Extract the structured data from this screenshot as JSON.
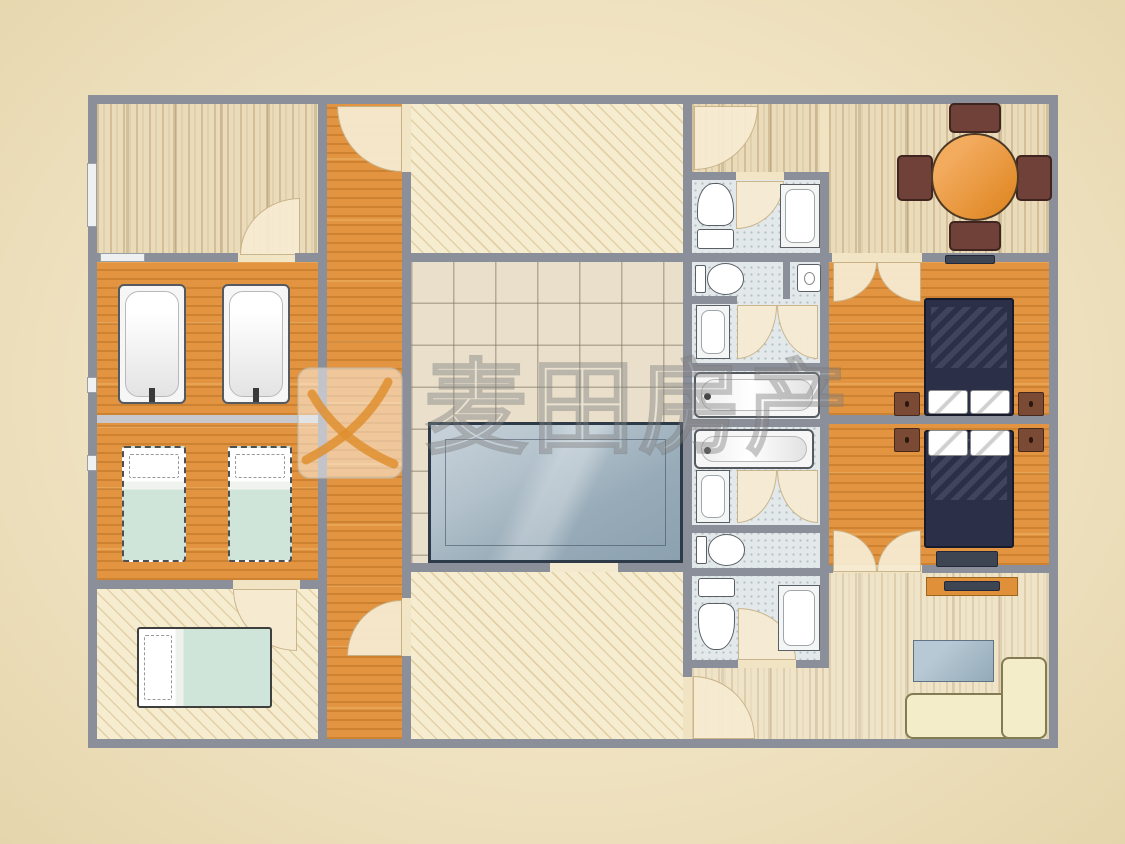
{
  "watermark": {
    "text": "麦田房产",
    "logo": "maitian-logo"
  },
  "palette": {
    "background": "#f0e3c2",
    "wall": "#8b8f99",
    "wood_floor": "#eadcba",
    "orange_floor": "#e29440",
    "hatch_floor": "#f6ecd0",
    "tile_floor": "#e9dfcb",
    "bath_floor": "#e3e9ea",
    "pool_water": "#9fb2bf",
    "bed_dark": "#2b3048",
    "bed_mint": "#cfe5da",
    "sofa_cream": "#f3edca",
    "table_orange": "#e18a28",
    "chair_brown": "#6f4138",
    "watermark_orange": "#df8f2f"
  },
  "floorplan": {
    "elements": [
      {
        "n": "top-left-room-floor",
        "c": "f-wood",
        "x": 97,
        "y": 104,
        "w": 221,
        "h": 149
      },
      {
        "n": "tub-room-floor",
        "c": "f-orange",
        "x": 97,
        "y": 262,
        "w": 221,
        "h": 153
      },
      {
        "n": "twin-bedroom-floor",
        "c": "f-orange",
        "x": 97,
        "y": 423,
        "w": 221,
        "h": 157
      },
      {
        "n": "bottom-left-bedroom-floor",
        "c": "f-hatch",
        "x": 97,
        "y": 589,
        "w": 221,
        "h": 150
      },
      {
        "n": "corridor-floor",
        "c": "f-orange",
        "x": 327,
        "y": 104,
        "w": 75,
        "h": 635
      },
      {
        "n": "top-center-room-floor",
        "c": "f-hatch",
        "x": 411,
        "y": 104,
        "w": 272,
        "h": 149
      },
      {
        "n": "pool-room-floor",
        "c": "f-grid",
        "x": 411,
        "y": 262,
        "w": 272,
        "h": 301
      },
      {
        "n": "bottom-center-room-floor",
        "c": "f-hatch",
        "x": 411,
        "y": 572,
        "w": 272,
        "h": 167
      },
      {
        "n": "top-band-floor",
        "c": "f-wood",
        "x": 692,
        "y": 104,
        "w": 128,
        "h": 68
      },
      {
        "n": "dining-room-floor",
        "c": "f-wood",
        "x": 829,
        "y": 104,
        "w": 220,
        "h": 149
      },
      {
        "n": "bathroom-column-floor",
        "c": "f-bath",
        "x": 692,
        "y": 180,
        "w": 128,
        "h": 480
      },
      {
        "n": "bedroom1-floor",
        "c": "f-orange",
        "x": 829,
        "y": 262,
        "w": 220,
        "h": 153
      },
      {
        "n": "bedroom2-floor",
        "c": "f-orange",
        "x": 829,
        "y": 424,
        "w": 220,
        "h": 141
      },
      {
        "n": "living-room-floor",
        "c": "f-woodlight",
        "x": 829,
        "y": 573,
        "w": 220,
        "h": 166
      },
      {
        "n": "living-room-ext-floor",
        "c": "f-woodlight",
        "x": 692,
        "y": 668,
        "w": 137,
        "h": 71
      },
      {
        "n": "door-arc-topleft-room",
        "c": "fan rTL",
        "x": 240,
        "y": 198,
        "w": 60,
        "h": 57
      },
      {
        "n": "door-arc-bottomleft-room",
        "c": "fan rBL",
        "x": 233,
        "y": 589,
        "w": 64,
        "h": 62
      },
      {
        "n": "door-arc-corridor-top",
        "c": "fan rBL",
        "x": 337,
        "y": 106,
        "w": 65,
        "h": 66
      },
      {
        "n": "door-arc-corridor-bottom",
        "c": "fan rTL",
        "x": 347,
        "y": 600,
        "w": 55,
        "h": 56
      },
      {
        "n": "door-arc-topband",
        "c": "fan rBR",
        "x": 694,
        "y": 106,
        "w": 64,
        "h": 64
      },
      {
        "n": "door-arc-bath1",
        "c": "fan rBR",
        "x": 736,
        "y": 181,
        "w": 48,
        "h": 48
      },
      {
        "n": "door-arc-bath3-left",
        "c": "fan rBR",
        "x": 737,
        "y": 305,
        "w": 40,
        "h": 54
      },
      {
        "n": "door-arc-bath3-right",
        "c": "fan rBL",
        "x": 777,
        "y": 305,
        "w": 41,
        "h": 54
      },
      {
        "n": "door-arc-bath5-left",
        "c": "fan rBR",
        "x": 737,
        "y": 470,
        "w": 40,
        "h": 53
      },
      {
        "n": "door-arc-bath5-right",
        "c": "fan rBL",
        "x": 777,
        "y": 470,
        "w": 41,
        "h": 53
      },
      {
        "n": "door-arc-bath7",
        "c": "fan rTR",
        "x": 738,
        "y": 608,
        "w": 58,
        "h": 52
      },
      {
        "n": "door-arc-bedroom1-left",
        "c": "fan rBR",
        "x": 833,
        "y": 262,
        "w": 44,
        "h": 40
      },
      {
        "n": "door-arc-bedroom1-right",
        "c": "fan rBL",
        "x": 877,
        "y": 262,
        "w": 44,
        "h": 40
      },
      {
        "n": "door-arc-bedroom2-left",
        "c": "fan rTR",
        "x": 833,
        "y": 530,
        "w": 44,
        "h": 42
      },
      {
        "n": "door-arc-bedroom2-right",
        "c": "fan rTL",
        "x": 877,
        "y": 530,
        "w": 44,
        "h": 42
      },
      {
        "n": "door-arc-living",
        "c": "fan rTR",
        "x": 693,
        "y": 676,
        "w": 62,
        "h": 63
      },
      {
        "n": "outer-wall-top",
        "c": "wall",
        "x": 88,
        "y": 95,
        "w": 970,
        "h": 9
      },
      {
        "n": "outer-wall-bottom",
        "c": "wall",
        "x": 88,
        "y": 739,
        "w": 970,
        "h": 9
      },
      {
        "n": "outer-wall-left",
        "c": "wall",
        "x": 88,
        "y": 95,
        "w": 9,
        "h": 653
      },
      {
        "n": "outer-wall-right",
        "c": "wall",
        "x": 1049,
        "y": 95,
        "w": 9,
        "h": 653
      },
      {
        "n": "wall-left-rooms",
        "c": "wall",
        "x": 318,
        "y": 104,
        "w": 9,
        "h": 635
      },
      {
        "n": "wall-corridor-right-upper",
        "c": "wall",
        "x": 402,
        "y": 172,
        "w": 9,
        "h": 426
      },
      {
        "n": "wall-corridor-right-lower",
        "c": "wall",
        "x": 402,
        "y": 656,
        "w": 9,
        "h": 83
      },
      {
        "n": "wall-center-right",
        "c": "wall",
        "x": 683,
        "y": 104,
        "w": 9,
        "h": 573
      },
      {
        "n": "wall-bath-right",
        "c": "wall",
        "x": 820,
        "y": 172,
        "w": 9,
        "h": 491
      },
      {
        "n": "wall-topleft-bottom-a",
        "c": "wall",
        "x": 88,
        "y": 253,
        "w": 12,
        "h": 9
      },
      {
        "n": "window-topleft-bottom",
        "c": "window",
        "x": 100,
        "y": 253,
        "w": 45,
        "h": 9
      },
      {
        "n": "wall-topleft-bottom-b",
        "c": "wall",
        "x": 145,
        "y": 253,
        "w": 93,
        "h": 9
      },
      {
        "n": "wall-topleft-bottom-c",
        "c": "wall",
        "x": 295,
        "y": 253,
        "w": 32,
        "h": 9
      },
      {
        "n": "wall-topcenter-bottom",
        "c": "wall",
        "x": 402,
        "y": 253,
        "w": 290,
        "h": 9
      },
      {
        "n": "wall-topright-bottom-a",
        "c": "wall",
        "x": 692,
        "y": 253,
        "w": 140,
        "h": 9
      },
      {
        "n": "wall-topright-bottom-b",
        "c": "wall",
        "x": 922,
        "y": 253,
        "w": 136,
        "h": 9
      },
      {
        "n": "window-bedroom1",
        "c": "darkbar",
        "x": 945,
        "y": 255,
        "w": 50,
        "h": 9
      },
      {
        "n": "wall-bath1-top-a",
        "c": "wall",
        "x": 692,
        "y": 172,
        "w": 44,
        "h": 8
      },
      {
        "n": "wall-bath1-top-b",
        "c": "wall",
        "x": 784,
        "y": 172,
        "w": 45,
        "h": 8
      },
      {
        "n": "wall-bath2-divider",
        "c": "wall",
        "x": 783,
        "y": 255,
        "w": 7,
        "h": 44
      },
      {
        "n": "wall-bath-h3",
        "c": "wall",
        "x": 692,
        "y": 296,
        "w": 45,
        "h": 8
      },
      {
        "n": "wall-bath-h4",
        "c": "wall",
        "x": 692,
        "y": 363,
        "w": 137,
        "h": 8
      },
      {
        "n": "wall-bath-h5",
        "c": "wall",
        "x": 692,
        "y": 419,
        "w": 137,
        "h": 8
      },
      {
        "n": "wall-bath-h6",
        "c": "wall",
        "x": 692,
        "y": 525,
        "w": 137,
        "h": 8
      },
      {
        "n": "wall-bath-h7",
        "c": "wall",
        "x": 692,
        "y": 568,
        "w": 137,
        "h": 8
      },
      {
        "n": "wall-bath-bottom-a",
        "c": "wall",
        "x": 683,
        "y": 660,
        "w": 55,
        "h": 8
      },
      {
        "n": "wall-bath-bottom-b",
        "c": "wall",
        "x": 796,
        "y": 660,
        "w": 33,
        "h": 8
      },
      {
        "n": "wall-bedroom-divider",
        "c": "wall",
        "x": 829,
        "y": 415,
        "w": 229,
        "h": 9
      },
      {
        "n": "wall-bedroom2-bottom-a",
        "c": "wall",
        "x": 829,
        "y": 565,
        "w": 4,
        "h": 8
      },
      {
        "n": "wall-bedroom2-bottom-b",
        "c": "wall",
        "x": 922,
        "y": 565,
        "w": 136,
        "h": 8
      },
      {
        "n": "wall-poolroom-bottom-a",
        "c": "wall",
        "x": 402,
        "y": 563,
        "w": 148,
        "h": 9
      },
      {
        "n": "door-opening-poolroom",
        "c": "gap",
        "x": 550,
        "y": 563,
        "w": 68,
        "h": 9
      },
      {
        "n": "wall-poolroom-bottom-b",
        "c": "wall",
        "x": 618,
        "y": 563,
        "w": 74,
        "h": 9
      },
      {
        "n": "wall-bottomleft-top-a",
        "c": "wall",
        "x": 88,
        "y": 580,
        "w": 145,
        "h": 9
      },
      {
        "n": "wall-bottomleft-top-b",
        "c": "wall",
        "x": 300,
        "y": 580,
        "w": 27,
        "h": 9
      },
      {
        "n": "divider-tub-bedroom",
        "c": "wall-light",
        "x": 97,
        "y": 415,
        "w": 221,
        "h": 8
      },
      {
        "n": "window-left-1",
        "c": "window",
        "x": 87,
        "y": 163,
        "w": 10,
        "h": 64
      },
      {
        "n": "window-left-2",
        "c": "window",
        "x": 87,
        "y": 377,
        "w": 10,
        "h": 16
      },
      {
        "n": "window-left-3",
        "c": "window",
        "x": 87,
        "y": 455,
        "w": 10,
        "h": 16
      },
      {
        "n": "bathtub-1",
        "c": "tub tubv",
        "x": 118,
        "y": 284,
        "w": 68,
        "h": 120
      },
      {
        "n": "bathtub-2",
        "c": "tub tubv",
        "x": 222,
        "y": 284,
        "w": 68,
        "h": 120
      },
      {
        "n": "faucet-1",
        "c": "stem",
        "x": 149,
        "y": 388,
        "w": 6,
        "h": 14
      },
      {
        "n": "faucet-2",
        "c": "stem",
        "x": 253,
        "y": 388,
        "w": 6,
        "h": 14
      },
      {
        "n": "single-bed-1",
        "c": "sbed",
        "x": 122,
        "y": 446,
        "w": 64,
        "h": 116
      },
      {
        "n": "single-bed-2",
        "c": "sbed",
        "x": 228,
        "y": 446,
        "w": 64,
        "h": 116
      },
      {
        "n": "double-bed-bottomleft",
        "c": "dbed",
        "x": 137,
        "y": 627,
        "w": 135,
        "h": 81
      },
      {
        "n": "swimming-pool",
        "c": "pool",
        "x": 428,
        "y": 422,
        "w": 255,
        "h": 141
      },
      {
        "n": "toilet-bath1",
        "c": "toiletD",
        "x": 697,
        "y": 183,
        "w": 37,
        "h": 66
      },
      {
        "n": "shower-bath1",
        "c": "shower",
        "x": 780,
        "y": 184,
        "w": 40,
        "h": 64
      },
      {
        "n": "toilet-bath2",
        "c": "toiletR",
        "x": 695,
        "y": 262,
        "w": 50,
        "h": 34
      },
      {
        "n": "sink-bath2",
        "c": "sink",
        "x": 797,
        "y": 264,
        "w": 24,
        "h": 28
      },
      {
        "n": "shower-bath3",
        "c": "shower",
        "x": 696,
        "y": 305,
        "w": 34,
        "h": 54
      },
      {
        "n": "bathtub-horizontal-1",
        "c": "tub tubh",
        "x": 694,
        "y": 372,
        "w": 126,
        "h": 46
      },
      {
        "n": "bathtub-horizontal-2",
        "c": "tub tubh",
        "x": 694,
        "y": 429,
        "w": 120,
        "h": 40
      },
      {
        "n": "shower-bath5",
        "c": "shower",
        "x": 696,
        "y": 470,
        "w": 34,
        "h": 53
      },
      {
        "n": "toilet-bath6",
        "c": "toiletR",
        "x": 696,
        "y": 533,
        "w": 50,
        "h": 34
      },
      {
        "n": "toilet-bath7",
        "c": "toiletU",
        "x": 698,
        "y": 578,
        "w": 37,
        "h": 72
      },
      {
        "n": "shower-bath7",
        "c": "shower",
        "x": 778,
        "y": 585,
        "w": 42,
        "h": 66
      },
      {
        "n": "dining-chair-north",
        "c": "chair",
        "x": 949,
        "y": 103,
        "w": 52,
        "h": 30
      },
      {
        "n": "dining-chair-south",
        "c": "chair",
        "x": 949,
        "y": 221,
        "w": 52,
        "h": 30
      },
      {
        "n": "dining-chair-west",
        "c": "chair",
        "x": 897,
        "y": 155,
        "w": 36,
        "h": 46
      },
      {
        "n": "dining-chair-east",
        "c": "chair",
        "x": 1016,
        "y": 155,
        "w": 36,
        "h": 46
      },
      {
        "n": "dining-table",
        "c": "dtable",
        "x": 931,
        "y": 133,
        "w": 88,
        "h": 88
      },
      {
        "n": "double-bed-1",
        "c": "bedD",
        "x": 924,
        "y": 298,
        "w": 90,
        "h": 118
      },
      {
        "n": "pillow-1a",
        "c": "pillow",
        "x": 928,
        "y": 390,
        "w": 40,
        "h": 24
      },
      {
        "n": "pillow-1b",
        "c": "pillow",
        "x": 970,
        "y": 390,
        "w": 40,
        "h": 24
      },
      {
        "n": "nightstand-1a",
        "c": "stand",
        "x": 894,
        "y": 392,
        "w": 26,
        "h": 24
      },
      {
        "n": "nightstand-1b",
        "c": "stand",
        "x": 1018,
        "y": 392,
        "w": 26,
        "h": 24
      },
      {
        "n": "double-bed-2",
        "c": "bedD",
        "x": 924,
        "y": 430,
        "w": 90,
        "h": 118
      },
      {
        "n": "pillow-2a",
        "c": "pillow",
        "x": 928,
        "y": 430,
        "w": 40,
        "h": 26
      },
      {
        "n": "pillow-2b",
        "c": "pillow",
        "x": 970,
        "y": 430,
        "w": 40,
        "h": 26
      },
      {
        "n": "nightstand-2a",
        "c": "stand",
        "x": 894,
        "y": 428,
        "w": 26,
        "h": 24
      },
      {
        "n": "nightstand-2b",
        "c": "stand",
        "x": 1018,
        "y": 428,
        "w": 26,
        "h": 24
      },
      {
        "n": "dresser-bedroom2",
        "c": "darkbar",
        "x": 936,
        "y": 551,
        "w": 62,
        "h": 16
      },
      {
        "n": "tv-stand",
        "c": "tvstand",
        "x": 926,
        "y": 577,
        "w": 92,
        "h": 19
      },
      {
        "n": "tv",
        "c": "darkbar",
        "x": 944,
        "y": 581,
        "w": 56,
        "h": 10
      },
      {
        "n": "coffee-table",
        "c": "bluetable",
        "x": 913,
        "y": 640,
        "w": 81,
        "h": 42
      },
      {
        "n": "sofa-main",
        "c": "sofa",
        "x": 905,
        "y": 693,
        "w": 142,
        "h": 46
      },
      {
        "n": "sofa-corner",
        "c": "sofa",
        "x": 1001,
        "y": 657,
        "w": 46,
        "h": 82
      }
    ]
  }
}
